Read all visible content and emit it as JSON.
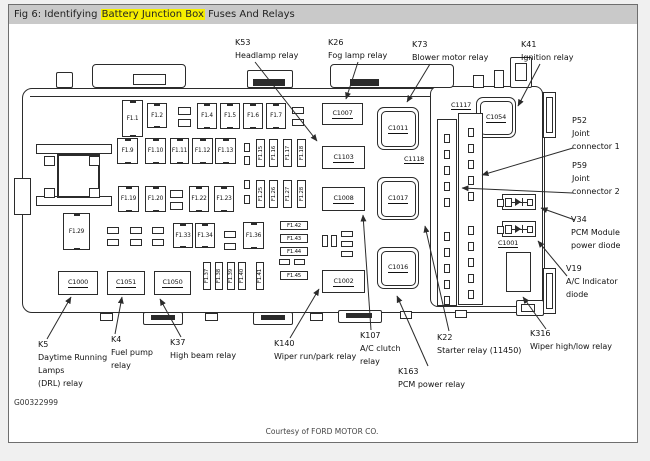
{
  "header": {
    "prefix": "Fig 6: Identifying ",
    "highlight": "Battery Junction Box",
    "suffix": " Fuses And Relays"
  },
  "colors": {
    "highlight_bg": "#f6ee00",
    "titlebar_bg": "#c9c9c9",
    "line": "#2b2b2b",
    "frame_border": "#6e6e6e",
    "page_bg": "#f0f0f0",
    "paper_bg": "#ffffff"
  },
  "fuses": [
    "F1.1",
    "F1.2",
    "F1.4",
    "F1.5",
    "F1.6",
    "F1.7",
    "F1.9",
    "F1.10",
    "F1.11",
    "F1.12",
    "F1.13",
    "F1.15",
    "F1.16",
    "F1.17",
    "F1.18",
    "F1.19",
    "F1.20",
    "F1.22",
    "F1.23",
    "F1.25",
    "F1.26",
    "F1.27",
    "F1.28",
    "F1.29",
    "F1.33",
    "F1.34",
    "F1.36",
    "F1.37",
    "F1.38",
    "F1.39",
    "F1.40",
    "F1.41",
    "F1.42",
    "F1.43",
    "F1.44",
    "F1.45"
  ],
  "connectors": [
    "C1000",
    "C1051",
    "C1050",
    "C1007",
    "C1103",
    "C1008",
    "C1002"
  ],
  "relay_sockets": [
    "C1011",
    "C1017",
    "C1016",
    "C1054"
  ],
  "point_labels": [
    "C1117",
    "C1118",
    "C1001"
  ],
  "callouts": [
    {
      "id": "k53",
      "lines": [
        "K53",
        "Headlamp relay"
      ]
    },
    {
      "id": "k26",
      "lines": [
        "K26",
        "Fog lamp relay"
      ]
    },
    {
      "id": "k73",
      "lines": [
        "K73",
        "Blower motor relay"
      ]
    },
    {
      "id": "k41",
      "lines": [
        "K41",
        "Ignition relay"
      ]
    },
    {
      "id": "p52",
      "lines": [
        "P52",
        "Joint",
        "connector 1"
      ]
    },
    {
      "id": "p59",
      "lines": [
        "P59",
        "Joint",
        "connector 2"
      ]
    },
    {
      "id": "v34",
      "lines": [
        "V34",
        "PCM Module",
        "power diode"
      ]
    },
    {
      "id": "v19",
      "lines": [
        "V19",
        "A/C Indicator",
        "diode"
      ]
    },
    {
      "id": "k316",
      "lines": [
        "K316",
        "Wiper high/low relay"
      ]
    },
    {
      "id": "k22",
      "lines": [
        "K22",
        "Starter relay (11450)"
      ]
    },
    {
      "id": "k163",
      "lines": [
        "K163",
        "PCM power relay"
      ]
    },
    {
      "id": "k107",
      "lines": [
        "K107",
        "A/C clutch",
        "relay"
      ]
    },
    {
      "id": "k140",
      "lines": [
        "K140",
        "Wiper run/park relay"
      ]
    },
    {
      "id": "k37",
      "lines": [
        "K37",
        "High beam relay"
      ]
    },
    {
      "id": "k4",
      "lines": [
        "K4",
        "Fuel pump",
        "relay"
      ]
    },
    {
      "id": "k5",
      "lines": [
        "K5",
        "Daytime Running",
        "Lamps",
        "(DRL) relay"
      ]
    }
  ],
  "figure_code": "G00322999",
  "courtesy": "Courtesy of FORD MOTOR CO."
}
